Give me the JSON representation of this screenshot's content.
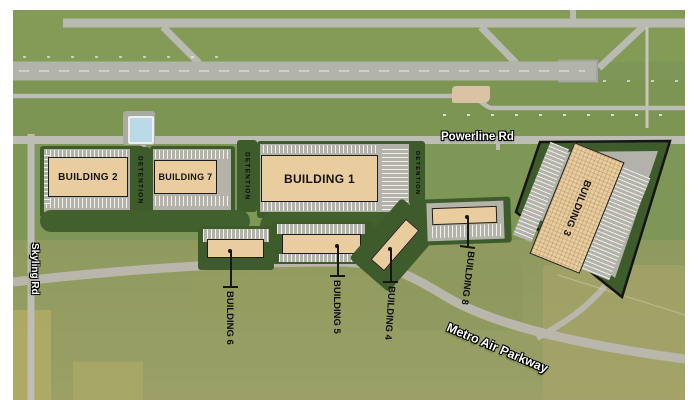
{
  "map": {
    "roads": {
      "powerline": "Powerline Rd",
      "skyling": "Skyling Rd",
      "metro_air": "Metro Air Parkway"
    },
    "detention_label": "DETENTION",
    "buildings": {
      "b1": {
        "label": "BUILDING 1"
      },
      "b2": {
        "label": "BUILDING 2"
      },
      "b3": {
        "label": "BUILDING 3"
      },
      "b4": {
        "label": "BUILDING 4"
      },
      "b5": {
        "label": "BUILDING 5"
      },
      "b6": {
        "label": "BUILDING 6"
      },
      "b7": {
        "label": "BUILDING 7"
      },
      "b8": {
        "label": "BUILDING 8"
      }
    },
    "palette": {
      "building_fill": "#e9cd9f",
      "building_border": "#1c1c1c",
      "site_green": "#3e5b2c",
      "parking_gray": "#b3b3aa",
      "road_gray": "#bdbdb4",
      "runway_gray": "#b2b4ab",
      "field_green": "#7f9756",
      "field_olive": "#9aa066",
      "pond_blue": "#badae8",
      "label_black": "#111111",
      "road_label_white": "#ffffff"
    }
  }
}
